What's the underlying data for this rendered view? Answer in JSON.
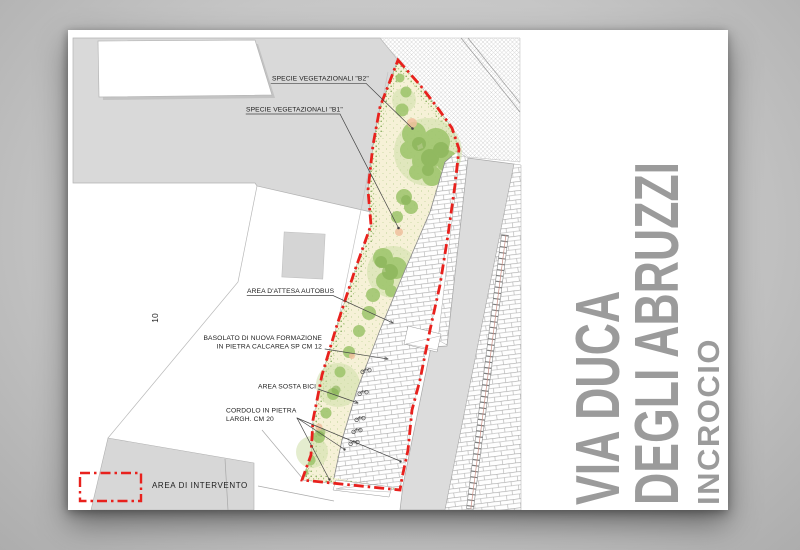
{
  "canvas": {
    "background": "#c6c6c6",
    "sheet_color": "#ffffff"
  },
  "titleblock": {
    "line1": "VIA DUCA",
    "line2": "DEGLI ABRUZZI",
    "line3": "INCROCIO",
    "color": "#9b9b9b"
  },
  "plan": {
    "labels": {
      "specie_b2": "SPECIE VEGETAZIONALI \"B2\"",
      "specie_b1": "SPECIE VEGETAZIONALI \"B1\"",
      "attesa_autobus": "AREA D'ATTESA AUTOBUS",
      "basolato_line1": "BASOLATO DI NUOVA FORMAZIONE",
      "basolato_line2": "IN PIETRA CALCAREA SP CM 12",
      "sosta_bici": "AREA SOSTA BICI",
      "cordolo_line1": "CORDOLO IN PIETRA",
      "cordolo_line2": "LARGH. CM 20",
      "scale_number": "10"
    },
    "legend": {
      "area_intervento": "AREA DI INTERVENTO"
    },
    "colors": {
      "boundary_red": "#e8211d",
      "vegetation_green": "#9cc36a",
      "vegetation_base": "#f6f1d7",
      "built_gray": "#d9d9d9",
      "line_gray": "#8a8a8a",
      "title_gray": "#9b9b9b"
    }
  }
}
